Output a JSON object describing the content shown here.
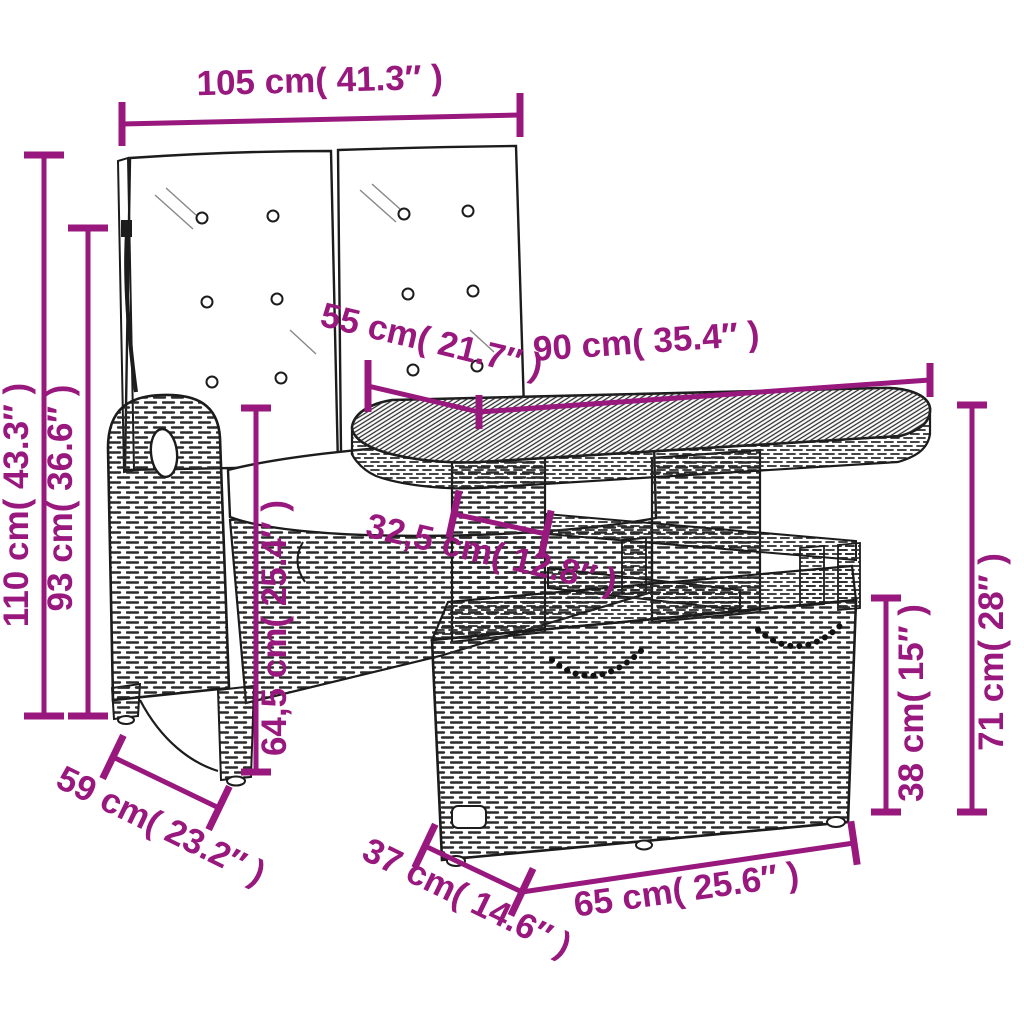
{
  "diagram": {
    "type": "product-dimension-diagram",
    "subject": "garden lounge set: 2-seater reclining rattan bench with cushions, slatted-top table and storage ottoman with chain handles",
    "background_color": "#ffffff",
    "line_art_color": "#1c1c1c",
    "dimension_color": "#98187E",
    "dimensions": {
      "bench_width": {
        "label": "105 cm( 41.3″ )"
      },
      "bench_height": {
        "label": "110 cm( 43.3″ )"
      },
      "backrest_height": {
        "label": "93 cm( 36.6″ )"
      },
      "table_depth": {
        "label": "55 cm( 21.7″ )"
      },
      "table_width": {
        "label": "90 cm( 35.4″ )"
      },
      "seat_depth": {
        "label": "32,5 cm( 12.8″ )"
      },
      "seat_height": {
        "label": "64,5 cm( 25.4″ )"
      },
      "ottoman_height": {
        "label": "38 cm( 15″ )"
      },
      "table_height": {
        "label": "71 cm( 28″ )"
      },
      "bench_depth": {
        "label": "59 cm( 23.2″ )"
      },
      "ottoman_depth": {
        "label": "37 cm( 14.6″ )"
      },
      "ottoman_width": {
        "label": "65 cm( 25.6″ )"
      }
    }
  }
}
